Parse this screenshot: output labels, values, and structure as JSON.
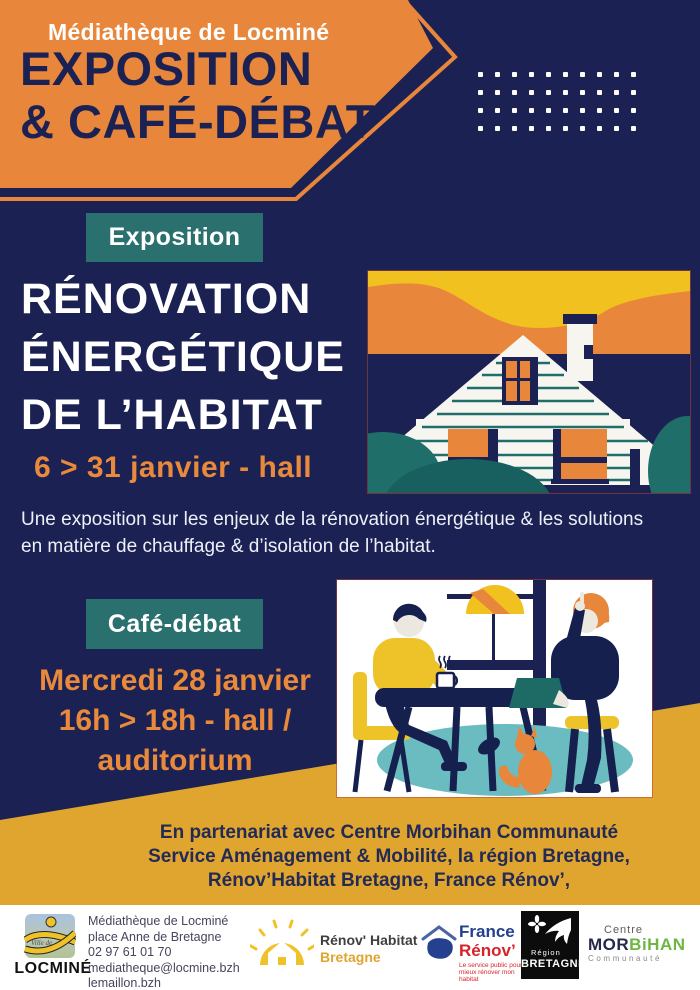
{
  "poster": {
    "header": {
      "kicker": "Médiathèque de Locminé",
      "title_line1": "EXPOSITION",
      "title_line2": "& CAFÉ-DÉBAT"
    },
    "dots": {
      "rows": 4,
      "cols": 10
    },
    "expo": {
      "badge": "Exposition",
      "title_lines": [
        "RÉNOVATION",
        "ÉNERGÉTIQUE",
        "DE L’HABITAT"
      ],
      "date": "6 > 31 janvier - hall",
      "description_lines": [
        "Une exposition sur les enjeux de la rénovation énergétique & les solutions",
        "en matière de chauffage  & d’isolation de l’habitat."
      ]
    },
    "cafe": {
      "badge": "Café-débat",
      "schedule_lines": [
        "Mercredi 28 janvier",
        "16h > 18h - hall /",
        "auditorium"
      ]
    },
    "partners_lines": [
      "En partenariat avec Centre Morbihan Communauté",
      "Service Aménagement & Mobilité, la région Bretagne,",
      "Rénov’Habitat Bretagne, France Rénov’,"
    ],
    "footer": {
      "locmine": {
        "prefix": "Ville de",
        "name": "LOCMINÉ"
      },
      "contact_lines": [
        "Médiathèque de Locminé",
        "place Anne de Bretagne",
        "02 97 61 01 70",
        "mediatheque@locmine.bzh",
        "lemaillon.bzh"
      ],
      "renov_habitat": {
        "line1": "Rénov' Habitat",
        "line2": "Bretagne"
      },
      "france_renov": {
        "line1": "France",
        "line2": "Rénov’",
        "tagline": "Le service public pour mieux rénover mon habitat"
      },
      "region_bretagne": {
        "line1": "Région",
        "line2": "BRETAGNE"
      },
      "centre_morbihan": {
        "line1": "Centre",
        "name_dark": "MOR",
        "name_green": "BiHAN",
        "line3": "Communauté"
      }
    },
    "colors": {
      "navy": "#1b2253",
      "orange": "#e8873b",
      "orange_text": "#e8893c",
      "teal": "#29706f",
      "mustard": "#dfa52e",
      "yellow": "#f1c120",
      "light_teal": "#6bbcc0",
      "france_blue": "#24408e",
      "france_red": "#d6232a",
      "green": "#6fb643",
      "white": "#ffffff"
    }
  }
}
